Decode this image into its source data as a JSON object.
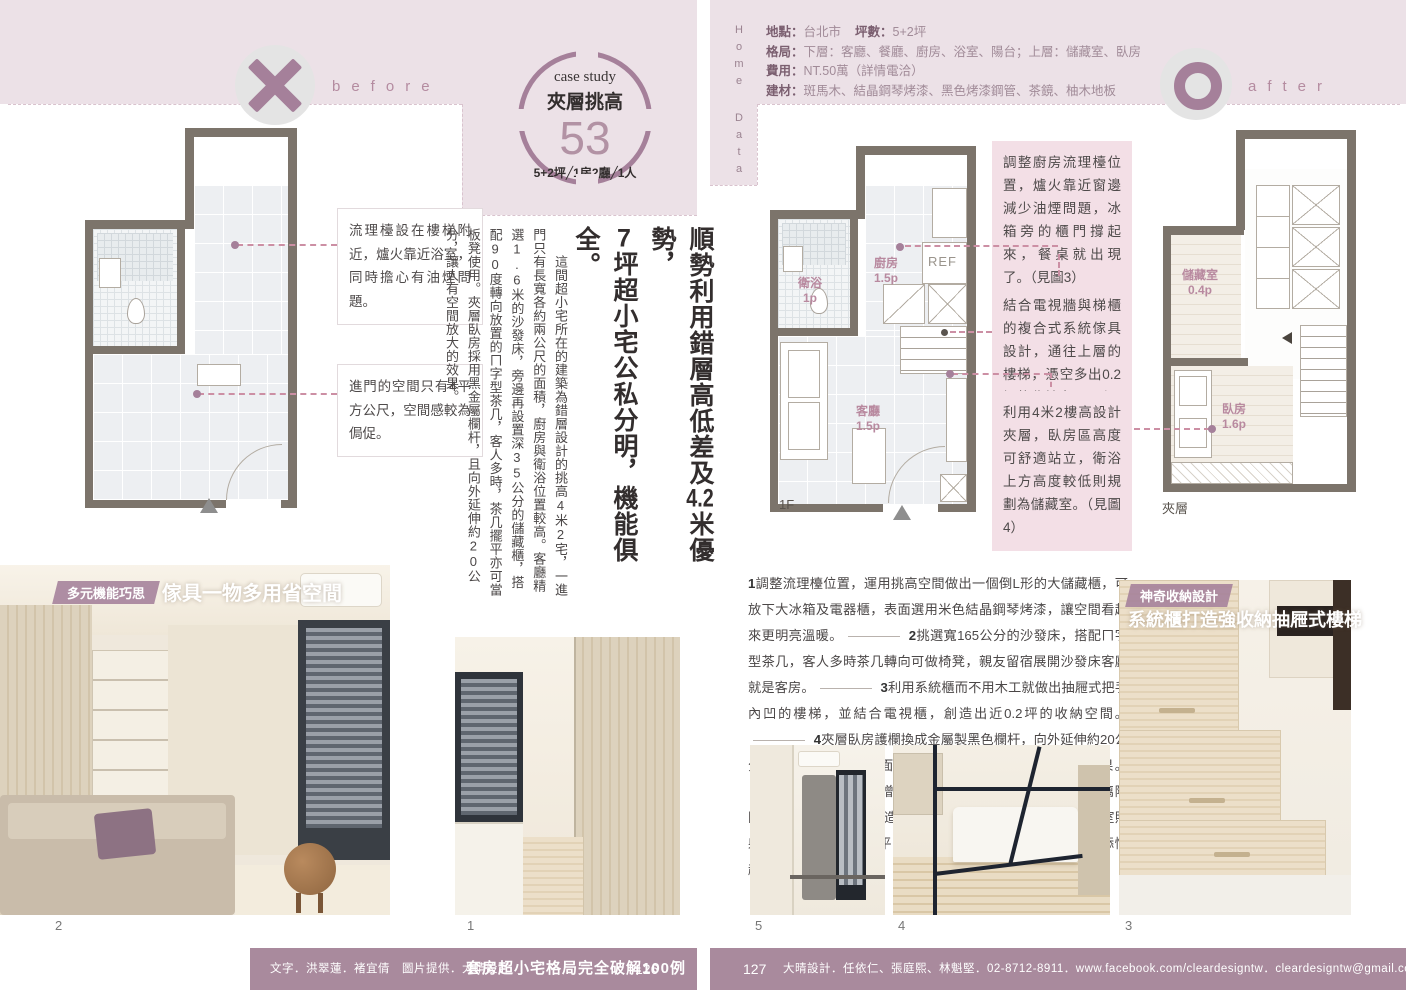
{
  "colors": {
    "accent": "#a5809a",
    "pink_band": "#ece1e7",
    "callout_bg": "#f3dfe6",
    "footer_bar": "#a98a9d",
    "plan_wall": "#7c746b"
  },
  "left_page": {
    "before_label": "before",
    "case_study": {
      "kicker": "case study",
      "title": "夾層挑高",
      "number": "53",
      "spec": "5+2坪╱1房2廳╱1人"
    },
    "plan_before": {
      "notes": [
        {
          "text": "流理檯設在樓梯附近，爐火靠近浴室，同時擔心有油煙問題。"
        },
        {
          "text": "進門的空間只有4平方公尺，空間感較為侷促。"
        }
      ]
    },
    "headline": {
      "l1a": "順勢利用錯層高低差及",
      "l1b": "4.2",
      "l1c": "米優勢，",
      "l2a": "7",
      "l2b": "坪超小宅公私分明，機能俱全。"
    },
    "body_text": "這間超小宅所在的建築為錯層設計的挑高4米2宅，一進門只有長寬各約兩公尺的面積，廚房與衛浴位置較高。客廳精選1.6米的沙發床，旁邊再設置深35公分的儲藏櫃，搭配90度轉向放置的ㄇ字型茶几，客人多時，茶几擺平亦可當板凳使用。夾層臥房採用黑金屬欄杆，且向外延伸約20公分，讓人有空間放大的效果。",
    "photo_caption": {
      "badge": "多元機能巧思",
      "title": "傢具一物多用省空間"
    },
    "photo_numbers": {
      "n2": "2",
      "n1": "1"
    },
    "footer": {
      "credits": "文字．洪翠蓮．褚宜倩　圖片提供．大晴設計",
      "book_title": "套房超小宅格局完全破解100例",
      "page": "126"
    }
  },
  "right_page": {
    "home_data": {
      "vertical_label": {
        "w1": "Home",
        "w2": "Data"
      },
      "rows": [
        {
          "pairs": [
            {
              "label": "地點：",
              "value": "台北市"
            },
            {
              "label": "坪數：",
              "value": "5+2坪"
            }
          ]
        },
        {
          "pairs": [
            {
              "label": "格局：",
              "value": "下層：客廳、餐廳、廚房、浴室、陽台；上層：儲藏室、臥房"
            }
          ]
        },
        {
          "pairs": [
            {
              "label": "費用：",
              "value": "NT.50萬（詳情電洽）"
            }
          ]
        },
        {
          "pairs": [
            {
              "label": "建材：",
              "value": "斑馬木、結晶鋼琴烤漆、黑色烤漆鋼管、茶鏡、柚木地板"
            }
          ]
        }
      ]
    },
    "after_label": "after",
    "plan_1f": {
      "label": "1F",
      "fridge": "REF",
      "rooms": {
        "bath_name": "衛浴",
        "bath_size": "1p",
        "kitchen_name": "廚房",
        "kitchen_size": "1.5p",
        "living_name": "客廳",
        "living_size": "1.5p"
      }
    },
    "plan_mezz": {
      "label": "夾層",
      "rooms": {
        "storage_name": "儲藏室",
        "storage_size": "0.4p",
        "bedroom_name": "臥房",
        "bedroom_size": "1.6p"
      }
    },
    "callouts": [
      {
        "text": "調整廚房流理檯位置，爐火靠近窗邊減少油煙問題，冰箱旁的櫃門撐起來，餐桌就出現了。（見圖3）"
      },
      {
        "text": "結合電視牆與梯櫃的複合式系統傢具設計，通往上層的樓梯，憑空多出0.2坪的收納空間。（見圖2）"
      },
      {
        "text": "利用4米2樓高設計夾層，臥房區高度可舒適站立，衛浴上方高度較低則規劃為儲藏室。（見圖4）"
      }
    ],
    "numbered_notes": [
      {
        "num": "1",
        "text": "調整流理檯位置，運用挑高空間做出一個倒L形的大儲藏櫃，可放下大冰箱及電器櫃，表面選用米色結晶鋼琴烤漆，讓空間看起來更明亮溫暖。"
      },
      {
        "num": "2",
        "text": "挑選寬165公分的沙發床，搭配ㄇ字型茶几，客人多時茶几轉向可做椅凳，親友留宿展開沙發床客廳就是客房。"
      },
      {
        "num": "3",
        "text": "利用系統櫃而不用木工就做出抽屜式把手內凹的樓梯，並結合電視櫃，創造出近0.2坪的收納空間。"
      },
      {
        "num": "4",
        "text": "夾層臥房護欄換成金屬製黑色欄杆，向外延伸約20公分，雖然實際使用的面積不變，卻讓人有空間放大的效果。"
      },
      {
        "num": "5",
        "text": "衛浴上方增設0.4坪的儲藏室，以噴砂強化玻璃隔間，設計師為餐廳做的造型天花板，光源可往下也可往儲藏室照射，並增加約0.2坪的平台供主人放置花草小物，為臥室增添情趣。"
      }
    ],
    "photo_caption": {
      "badge": "神奇收納設計",
      "title": "系統櫃打造強收納抽屜式樓梯"
    },
    "photo_numbers": {
      "n5": "5",
      "n4": "4",
      "n3": "3"
    },
    "footer": {
      "page": "127",
      "credits": "大晴設計．任依仁、張庭熙、林魁堅．02-8712-8911．www.facebook.com/cleardesigntw．cleardesigntw@gmail.com"
    }
  }
}
